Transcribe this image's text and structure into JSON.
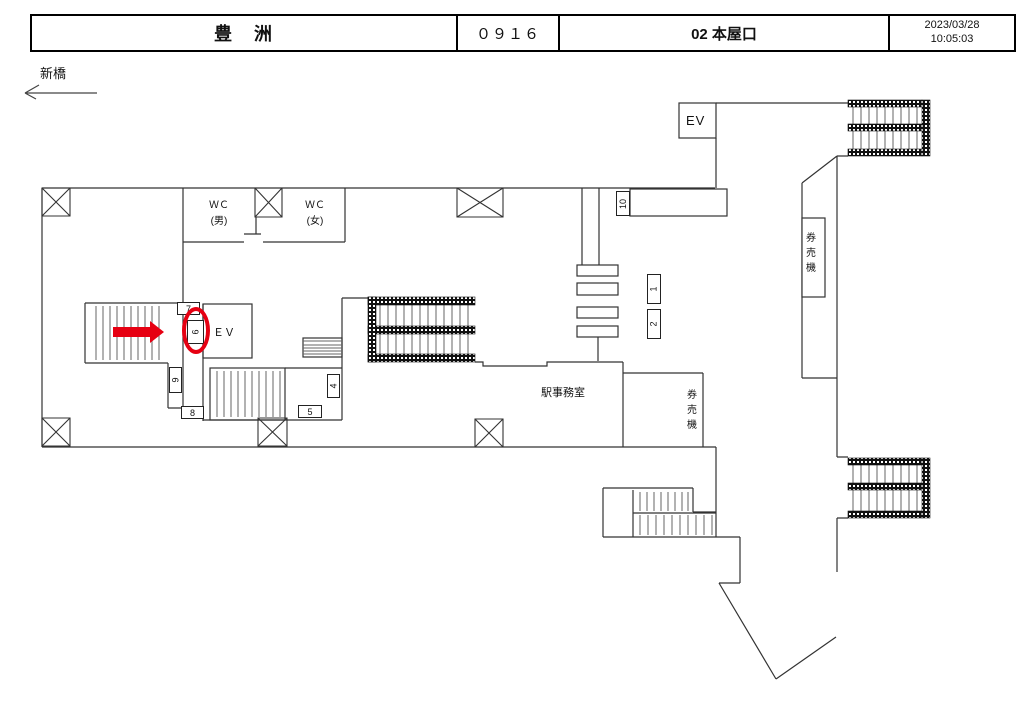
{
  "header": {
    "station_name": "豊　洲",
    "station_code": "０９１６",
    "exit_name": "02 本屋口",
    "date": "2023/03/28",
    "time": "10:05:03"
  },
  "direction": {
    "label": "新橋"
  },
  "map": {
    "labels": {
      "wc_men": "ＷＣ\n(男)",
      "wc_women": "ＷＣ\n(女)",
      "ev_left": "ＥＶ",
      "ev_top": "EV",
      "office": "駅事務室",
      "ticket_machine_right": "券売機",
      "ticket_machine_bottom": "券売機"
    },
    "signs": [
      {
        "label": "7"
      },
      {
        "label": "6"
      },
      {
        "label": "9"
      },
      {
        "label": "8"
      },
      {
        "label": "4"
      },
      {
        "label": "5"
      },
      {
        "label": "10"
      },
      {
        "label": "1"
      },
      {
        "label": "2"
      }
    ],
    "highlight": {
      "circled_sign": "6",
      "color": "#e60012"
    }
  }
}
